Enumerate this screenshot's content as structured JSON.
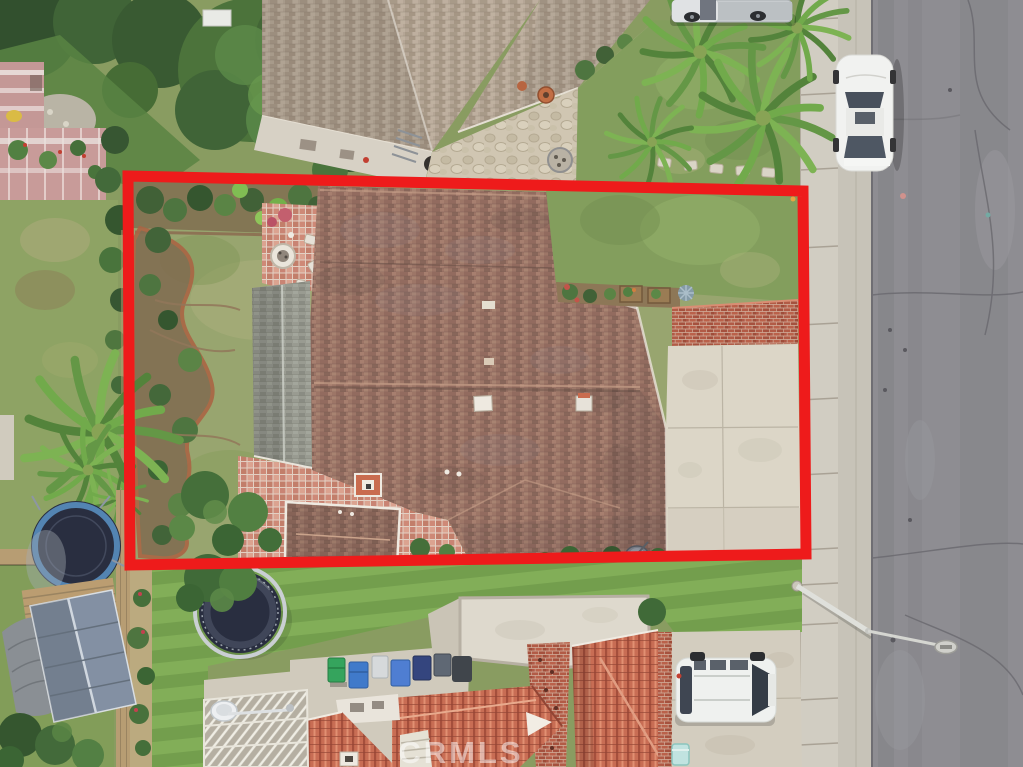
{
  "watermark": {
    "text": "CRMLS",
    "color": "#ffffff",
    "opacity": 0.5
  },
  "annotation": {
    "label": "property-boundary-outline",
    "color": "#ee1b1b",
    "stroke_width": 11,
    "points": "128,176 803,191 806,554 130,565"
  },
  "palette": {
    "asphalt": "#8b8a8f",
    "sidewalk": "#d0ccc0",
    "gutter": "#c6c2b6",
    "roof_brown": "#9a7263",
    "roof_gray": "#96988e",
    "roof_tan_neighbor": "#b3a493",
    "roof_tile_red": "#c7694f",
    "flat_roof": "#ddd8cc",
    "driveway": "#dbd5c6",
    "driveway_bottom": "#d2ccbd",
    "lawn_front": "#7f9b58",
    "lawn_back": "#95a36b",
    "lawn_bottom": "#6f9b48",
    "lawn_stripe": "#7eac53",
    "hedge_dark": "#31512c",
    "palm_green": "#5f9440",
    "paver_salmon": "#cd8673",
    "brick_red": "#b05640",
    "car_white": "#f1f2f0",
    "suv_white": "#eff1ef",
    "truck_silver": "#c6cacd",
    "trampoline_mat": "#23283a",
    "trampoline_ring_blue": "#4e80b0",
    "bin_green": "#2fa258",
    "bin_blue": "#3a76c9",
    "bin_navy": "#2e3f7a",
    "shed_blue_gray": "#7f8da0"
  },
  "scene": {
    "objects": [
      "subject-house-roof",
      "patio-cover-gray-roof",
      "paver-patio",
      "fire-pit",
      "garden-bed",
      "front-lawn",
      "driveway",
      "brick-wall",
      "satellite-dish",
      "neighbor-house-top",
      "flagstone-patio",
      "palm-trees",
      "pickup-truck",
      "white-sedan",
      "street",
      "sidewalk",
      "street-light",
      "bottom-neighbor-house",
      "flat-roof",
      "tile-roof",
      "trash-bins",
      "lattice-patio-cover",
      "white-suv",
      "trampolines",
      "storage-shed",
      "wood-fence"
    ]
  }
}
